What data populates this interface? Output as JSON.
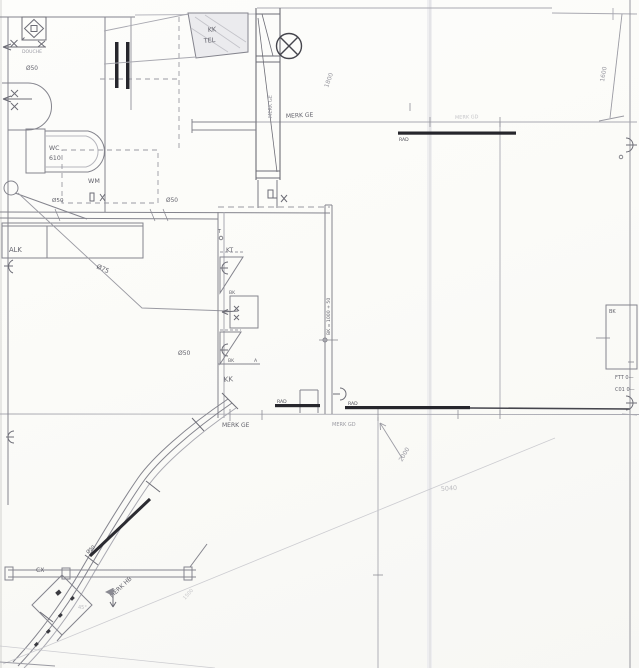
{
  "drawing": {
    "kind": "scanned hand-drawn architectural floor plan (pencil)",
    "colors": {
      "paper": "#fcfcfa",
      "pencil_light": "#b6b6bd",
      "pencil": "#84848d",
      "pencil_dark": "#5a5a62",
      "ink_bar": "#26262c",
      "scan_band": "#e9e9eb"
    },
    "labels": {
      "kk": "KK",
      "tel": "TEL",
      "douche": "DOUCHE",
      "douche_dia": "Ø50",
      "wc": "WC",
      "wc_num": "610",
      "wm": "WM",
      "wm_dia": "Ø50",
      "wall_dia50": "Ø50",
      "alk": "ALK",
      "pipe_dia75": "Ø75",
      "kt": "KT",
      "bk1": "BK",
      "bk2": "BK",
      "a_mark": "A",
      "kk_cab": "KK",
      "kk_dia50": "Ø50",
      "bk_note": "BK = 1000 + 50",
      "t_mark": "T",
      "merk_ge_v": "MERK GE",
      "merk_ge_h": "MERK GE",
      "d1800": "1800",
      "d1600": "1600",
      "rad_top": "RAD",
      "merk_gd_top": "MERK GD",
      "rad1": "RAD",
      "rad2": "RAD",
      "merk_ge_mid": "MERK GE",
      "merk_gd_mid": "MERK GD",
      "d2000": "2000",
      "d5040": "5040",
      "bk_box": "BK",
      "ftt": "FTT 0—",
      "co1": "C01 0—",
      "dia50_diag": "Ø50",
      "merk_hb": "MERK HB",
      "d1500": "1500",
      "deg45": "45°",
      "cx": "CX"
    }
  }
}
